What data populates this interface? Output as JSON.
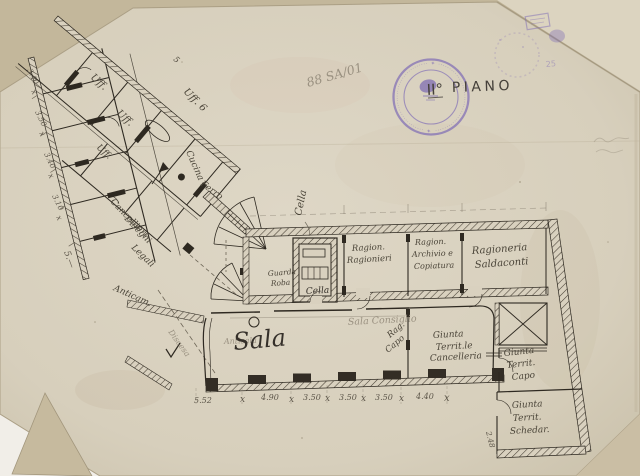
{
  "scan": {
    "archive_note": "88 SA/01",
    "floor_label": "II°",
    "floor_word": "PIANO",
    "corner_number": "25",
    "stamp_ring_text": "✦ ········································ ✦ ········································"
  },
  "rooms": {
    "uff_a": "Uff.",
    "uff_b": "Uff.",
    "uff_c": "Uff.",
    "num5": "5",
    "uff_6": "Uff. 6",
    "cucina": "Cucina",
    "ferro": "Ferro",
    "cancellieri_1": "Cancellieri",
    "cancellieri_2": "Disegni",
    "legali": "Legali",
    "anticamera": "Anticam.",
    "discesa": "Discesa",
    "antisala": "Antisala",
    "guardaroba_1": "Guarda",
    "guardaroba_2": "Roba",
    "cella_note": "Cella",
    "cella": "Cella",
    "rag_ragionieri_1": "Ragion.",
    "rag_ragionieri_2": "Ragionieri",
    "rag_archivio_1": "Ragion.",
    "rag_archivio_2": "Archivio e",
    "rag_archivio_3": "Copiatura",
    "ragioneria_1": "Ragioneria",
    "ragioneria_2": "Saldaconti",
    "sala": "Sala",
    "sala_consiglio": "Sala Consiglio",
    "rag_capo_1": "Rag.",
    "rag_capo_2": "Capo",
    "giunta_canc_1": "Giunta",
    "giunta_canc_2": "Territ.le",
    "giunta_canc_3": "Cancelleria",
    "giunta_capo_1": "Giunta",
    "giunta_capo_2": "Territ.",
    "giunta_capo_3": "Capo",
    "giunta_sched_1": "Giunta",
    "giunta_sched_2": "Territ.",
    "giunta_sched_3": "Schedar."
  },
  "dims": {
    "bottom": [
      "5.52",
      "x",
      "4.90",
      "x",
      "3.50",
      "x",
      "3.50",
      "x",
      "3.50",
      "x",
      "4.40",
      "x"
    ],
    "left": [
      "3.40",
      "x",
      "3.50",
      "x",
      "3.40",
      "x",
      "3.10",
      "x"
    ],
    "left_extra": "5.—",
    "right": "2.48"
  },
  "colors": {
    "paper": "#d9d1bf",
    "backing": "#c5b99d",
    "stamp_purple": "#7e6bb5",
    "ink": "#2e2921",
    "pencil": "#6f6758"
  }
}
